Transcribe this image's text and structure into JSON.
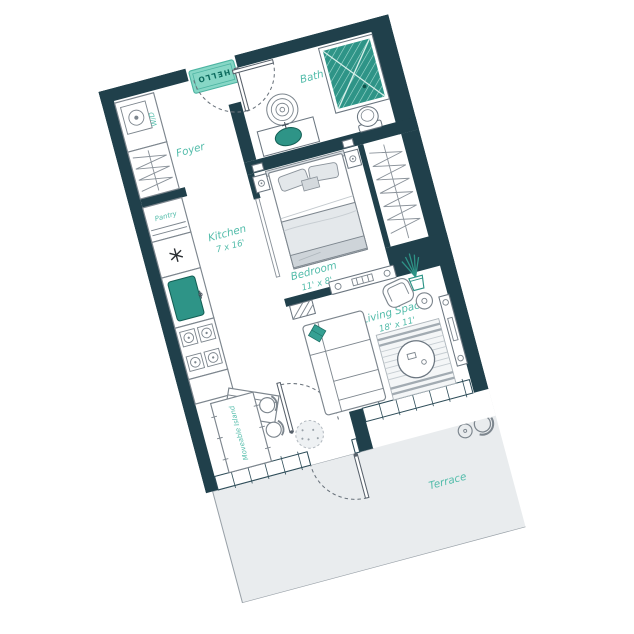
{
  "floorplan": {
    "door_mat_text": "HELLO",
    "rooms": {
      "foyer": {
        "label": "Foyer"
      },
      "bath": {
        "label": "Bath"
      },
      "kitchen": {
        "label": "Kitchen",
        "dims": "7 x 16'"
      },
      "bedroom": {
        "label": "Bedroom",
        "dims": "11' x 8'"
      },
      "living": {
        "label": "Living Space",
        "dims": "18' x 11'"
      },
      "terrace": {
        "label": "Terrace"
      }
    },
    "fixtures": {
      "laundry": {
        "label": "W/D"
      },
      "pantry": {
        "label": "Pantry"
      },
      "island": {
        "label": "Moveable Island"
      }
    },
    "colors": {
      "wall": "#20404b",
      "label_teal": "#52bcaa",
      "fixture_teal": "#2e9487",
      "mat_fill": "#87d7c6",
      "terrace_fill": "#e9ecee",
      "furniture_line": "#7d868e"
    }
  }
}
